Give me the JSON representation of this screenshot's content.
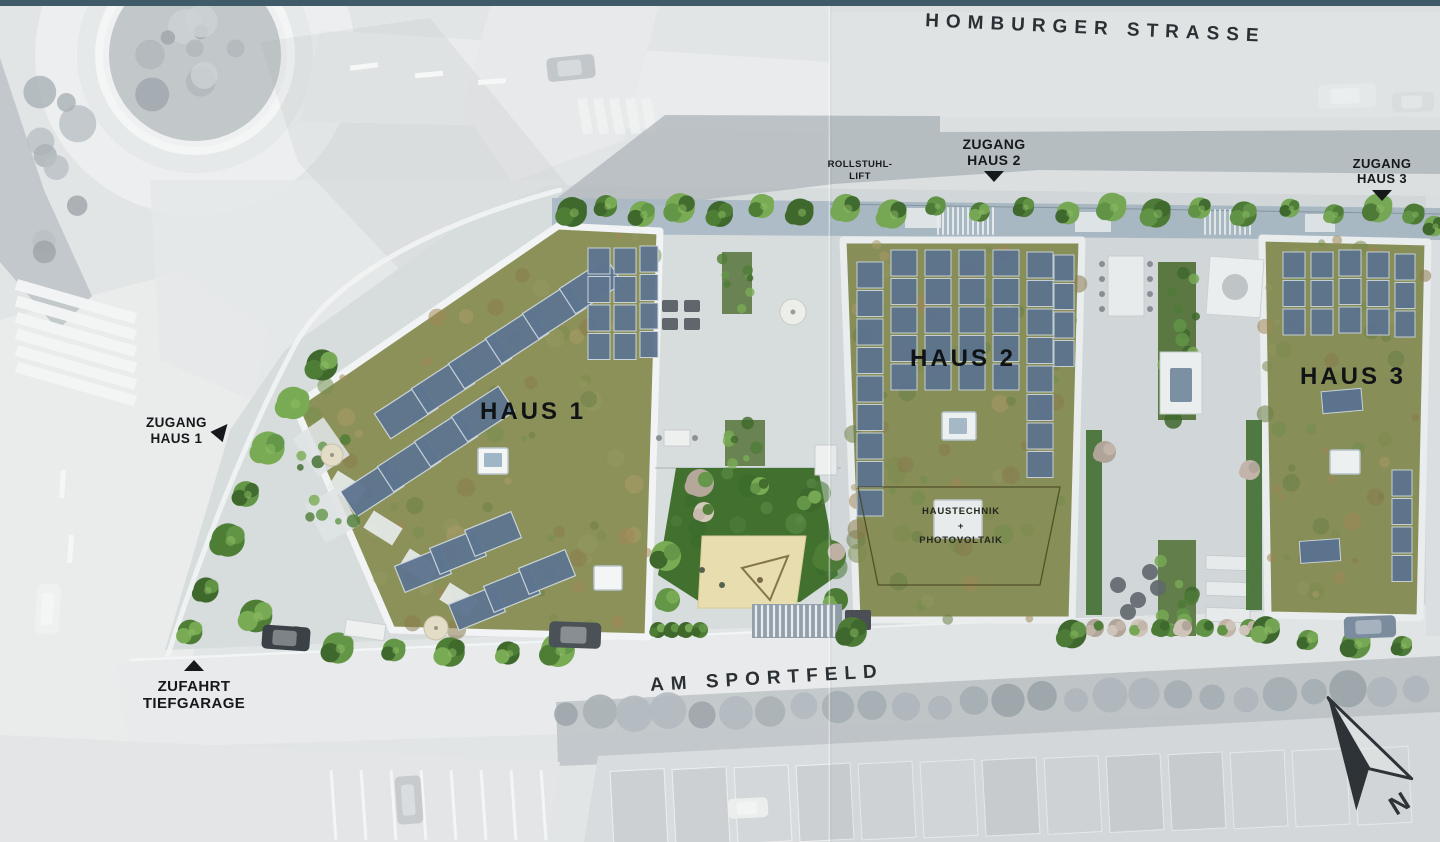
{
  "streets": {
    "top": "HOMBURGER STRASSE",
    "bottom": "AM SPORTFELD"
  },
  "buildings": [
    {
      "label": "HAUS 1"
    },
    {
      "label": "HAUS 2"
    },
    {
      "label": "HAUS 3"
    }
  ],
  "annotations": {
    "zugang_haus_1": {
      "line1": "ZUGANG",
      "line2": "HAUS 1"
    },
    "zugang_haus_2": {
      "line1": "ZUGANG",
      "line2": "HAUS 2"
    },
    "zugang_haus_3": {
      "line1": "ZUGANG",
      "line2": "HAUS 3"
    },
    "rollstuhl_lift": {
      "line1": "ROLLSTUHL-",
      "line2": "LIFT"
    },
    "zufahrt_tiefgarage": {
      "line1": "ZUFAHRT",
      "line2": "TIEFGARAGE"
    },
    "haustechnik": {
      "line1": "HAUSTECHNIK",
      "line2": "+",
      "line3": "PHOTOVOLTAIK"
    },
    "compass_n": "N"
  },
  "colors": {
    "page_border_teal": "#3f5b69",
    "gray_bg": "#e2e5e6",
    "gray_street": "#e9ebec",
    "gray_veg": "#b7bdc1",
    "gray_shadow": "#b2b8bd",
    "site_paving": "#d7dcdd",
    "north_path": "#a9b8c4",
    "wall_white": "#f1f3f4",
    "roof_base": "#8b9158",
    "panel_blue": "#5e7590",
    "panel_frame": "#cdd6de",
    "lawn": "#41702f",
    "sand": "#e8ddae",
    "label_dark": "#16191c",
    "street_text": "#2b3034",
    "roof_mottle": [
      "#7f8c51",
      "#949960",
      "#8d7c4e",
      "#a3895a",
      "#6e8047",
      "#ac9a67",
      "#77904f"
    ],
    "tree_greens": [
      "#3f692c",
      "#4e7d36",
      "#639647",
      "#79ab55"
    ],
    "blossom": [
      "#c9b8ae",
      "#b5a89b",
      "#d4c9bd"
    ],
    "lawn_light": [
      "#4f7d3d",
      "#5d8c48",
      "#3a6a2d"
    ]
  }
}
